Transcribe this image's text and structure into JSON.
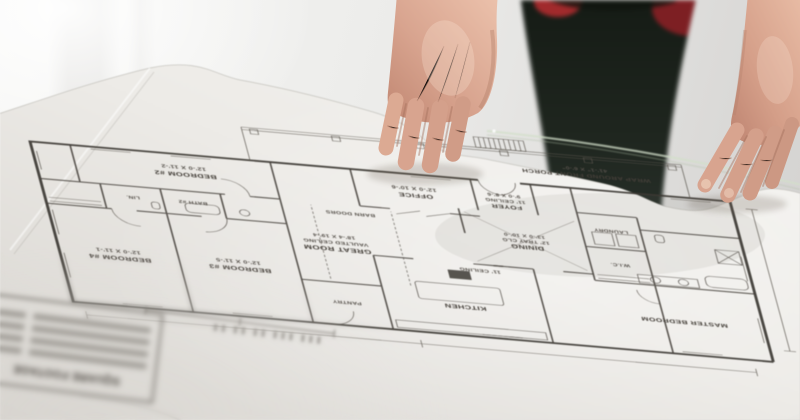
{
  "scene": {
    "type": "photograph",
    "description": "Two hands of a person in dark clothing resting on an upside-down architectural floor plan sheet lying on a glass table in a bright room",
    "colors": {
      "background_wall": "#ececea",
      "paper": "#f0eeeb",
      "plan_ink": "#3c3833",
      "skin": "#d8a48f",
      "clothing_dark": "#1c221c",
      "accent_red": "#8c2226",
      "glass_edge": "#cdd9c6"
    }
  },
  "plan": {
    "rooms": {
      "bedroom2": {
        "name": "BEDROOM #2",
        "dim": "12'-0 X 11'-2"
      },
      "bedroom3": {
        "name": "BEDROOM #3",
        "dim": "12'-0 X 11'-5"
      },
      "bedroom4": {
        "name": "BEDROOM #4",
        "dim": "12'-0 X 11'-1"
      },
      "office": {
        "name": "OFFICE",
        "dim": "12'-0 X 10'-6"
      },
      "foyer": {
        "name": "FOYER",
        "note": "11' CEILING",
        "dim": "9'-0 X 8'-6"
      },
      "dining": {
        "name": "DINING",
        "note": "12' TRAY CLG",
        "dim": "13'-0 X 10'-0"
      },
      "great_room": {
        "name": "GREAT ROOM",
        "note": "VAULTED CEILING",
        "dim": "18'-4 X 19'-4"
      },
      "kitchen": {
        "name": "KITCHEN"
      },
      "master": {
        "name": "MASTER BEDROOM"
      },
      "laundry": {
        "name": "LAUNDRY"
      },
      "bath2": {
        "name": "BATH #2"
      },
      "wic": {
        "name": "W.I.C."
      },
      "pantry": {
        "name": "PANTRY"
      },
      "lin": {
        "name": "LIN."
      }
    },
    "porch": {
      "name": "WRAP AROUND FRONT PORCH",
      "dim": "41'-1\" X 6'-0\""
    },
    "notes": {
      "barn_doors": "BARN DOORS",
      "ceiling11": "11' CEILING"
    },
    "title_block": {
      "heading": "SQUARE FOOTAGE"
    }
  }
}
